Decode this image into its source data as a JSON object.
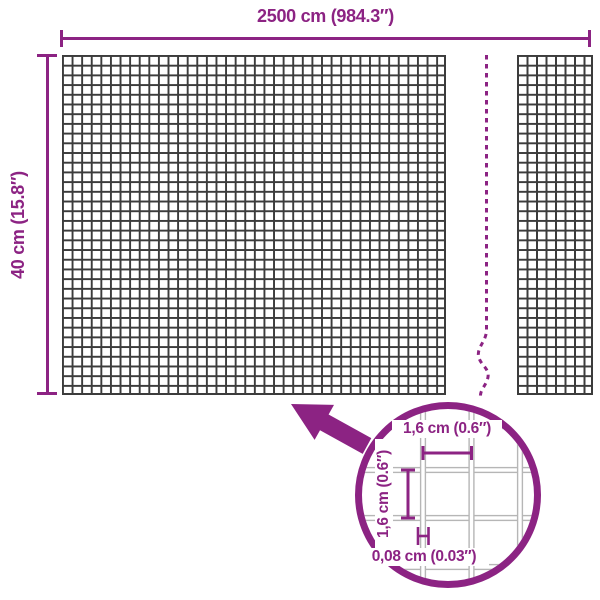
{
  "diagram": {
    "overall_width_label": "2500 cm (984.3″)",
    "overall_height_label": "40 cm (15.8″)",
    "detail": {
      "cell_width_label": "1,6 cm (0.6″)",
      "cell_height_label": "1,6 cm (0.6″)",
      "wire_thickness_label": "0,08 cm (0.03″)"
    },
    "colors": {
      "accent": "#8c2383",
      "mesh_line": "#3c3c3c",
      "detail_wire": "#b6b6b6"
    }
  }
}
